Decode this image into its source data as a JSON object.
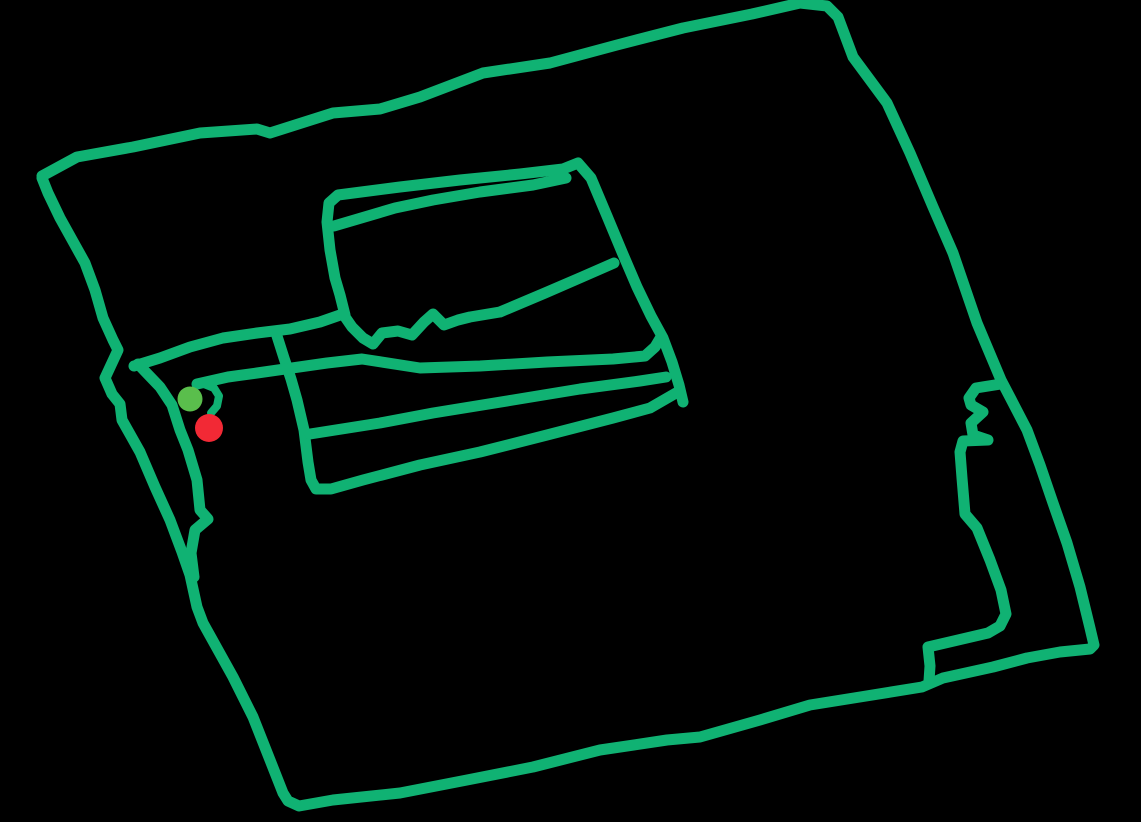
{
  "canvas": {
    "width": 1141,
    "height": 822,
    "background_color": "#000000"
  },
  "sketch": {
    "stroke_color": "#10B273",
    "stroke_width": 11,
    "stroke_linecap": "round",
    "stroke_linejoin": "round",
    "strokes": [
      {
        "name": "outer-boundary-stroke",
        "points": "42,176 77,157 133,147 200,133 257,129 270,133 333,113 380,109 420,97 483,73 550,63 617,45 683,28 752,14 800,3 827,6 838,17 853,57 887,103 910,153 933,207 953,253 977,323 1001,380 1013,403 1027,430 1040,465 1053,503 1067,543 1080,587 1090,628 1094,645 1090,649 1060,652 1027,658 993,667 943,678 922,687 860,697 810,705 760,720 700,737 667,740 600,750 533,767 467,780 400,793 333,800 299,806 288,801 283,793 270,760 253,717 233,677 218,650 203,623 197,607 190,575 182,552 170,520 155,487 140,452 122,420 120,404 112,394 105,378 118,350 113,340 103,318 95,290 85,263 75,245 60,218 48,193 42,178"
      },
      {
        "name": "inner-fork-stroke",
        "points": "138,364 160,387 172,405 180,430 188,450 197,480 200,510 208,519 195,530 191,553 194,577"
      },
      {
        "name": "road-and-middle-stripe-stroke",
        "points": "134,366 160,358 190,347 223,338 257,333 290,329 320,322 343,314 352,327 363,338 373,344 382,333 398,331 412,335 424,322 433,314 444,325 458,320 470,317 500,312 545,293 582,277 614,263"
      },
      {
        "name": "field-upper-outline-stroke",
        "points": "345,315 340,295 335,278 330,250 327,222 329,203 338,195 400,187 460,180 520,174 563,169 578,163 591,178 607,216 622,252 637,287 651,316 663,338 672,362 679,385 683,402"
      },
      {
        "name": "field-lid-line-stroke",
        "points": "334,226 395,208 433,200 480,192 533,185 566,178"
      },
      {
        "name": "field-lower-outline-stroke",
        "points": "277,336 284,358 291,379 297,400 304,430 308,462 311,480 316,489 331,489 363,480 420,465 480,452 547,435 613,418 650,408 676,393"
      },
      {
        "name": "lower-road-stripe-stroke",
        "points": "197,384 228,377 257,373 292,368 327,363 362,359 420,368 480,366 547,362 613,359 645,356 655,347 661,337"
      },
      {
        "name": "field-stripe-line-stroke",
        "points": "310,434 380,423 433,413 513,400 580,389 640,381 666,377"
      },
      {
        "name": "right-step-shape-stroke",
        "points": "1001,384 976,388 969,398 971,405 983,412 971,423 973,435 988,440 963,441 960,452 962,478 965,514 977,528 990,560 1001,590 1006,614 1000,626 988,633 928,647 930,666 929,681"
      },
      {
        "name": "marker-hook-stroke",
        "points": "204,384 214,388 219,396 217,406 211,413",
        "width": 8
      }
    ],
    "markers": [
      {
        "name": "start-marker-green-dot",
        "cx": 190,
        "cy": 399,
        "r": 12.5,
        "color": "#5ABE4C"
      },
      {
        "name": "end-marker-red-dot",
        "cx": 209,
        "cy": 428,
        "r": 14,
        "color": "#F22935"
      }
    ]
  }
}
